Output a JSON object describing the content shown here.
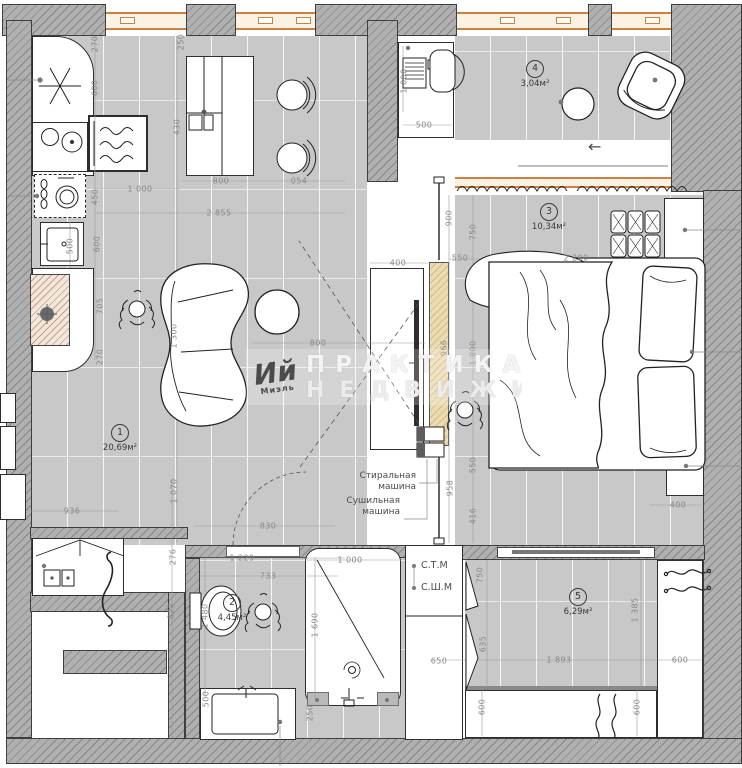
{
  "watermark": {
    "logo": "Ий",
    "logo_sub": "Миэль",
    "line1": "ПРАКТИКА",
    "line2": "НЕДВИЖИМ"
  },
  "rooms": [
    {
      "num": "1",
      "area": "20,69м²",
      "x": 98,
      "y": 424
    },
    {
      "num": "2",
      "area": "4,45м²",
      "x": 210,
      "y": 594
    },
    {
      "num": "3",
      "area": "10,34м²",
      "x": 527,
      "y": 203
    },
    {
      "num": "4",
      "area": "3,04м²",
      "x": 513,
      "y": 60
    },
    {
      "num": "5",
      "area": "6,29м²",
      "x": 556,
      "y": 588
    }
  ],
  "annotations": [
    {
      "lines": [
        "Стиральная",
        "машина"
      ],
      "x": 330,
      "y": 471,
      "w": 86,
      "align": "right",
      "fs": 9
    },
    {
      "lines": [
        "Сушильная",
        "машина"
      ],
      "x": 316,
      "y": 496,
      "w": 84,
      "align": "right",
      "fs": 9
    },
    {
      "lines": [
        "С.Т.М"
      ],
      "x": 421,
      "y": 560,
      "w": 42,
      "align": "left",
      "fs": 9.5
    },
    {
      "lines": [
        "С.Ш.М"
      ],
      "x": 421,
      "y": 582,
      "w": 46,
      "align": "left",
      "fs": 9.5
    },
    {
      "lines": [
        "←"
      ],
      "x": 588,
      "y": 138,
      "w": 30,
      "align": "left",
      "fs": 16
    }
  ],
  "dimensions": [
    {
      "text": "270",
      "x": 95,
      "y": 44,
      "v": true
    },
    {
      "text": "250",
      "x": 181,
      "y": 42,
      "v": true
    },
    {
      "text": "600",
      "x": 95,
      "y": 88,
      "v": true
    },
    {
      "text": "430",
      "x": 177,
      "y": 127,
      "v": true
    },
    {
      "text": "450",
      "x": 95,
      "y": 197,
      "v": true
    },
    {
      "text": "600",
      "x": 97,
      "y": 244,
      "v": true
    },
    {
      "text": "705",
      "x": 100,
      "y": 306,
      "v": true
    },
    {
      "text": "270",
      "x": 100,
      "y": 357,
      "v": true
    },
    {
      "text": "500",
      "x": 70,
      "y": 246,
      "v": true
    },
    {
      "text": "1 000",
      "x": 140,
      "y": 189,
      "v": false
    },
    {
      "text": "800",
      "x": 221,
      "y": 181,
      "v": false
    },
    {
      "text": "054",
      "x": 299,
      "y": 181,
      "v": false
    },
    {
      "text": "2 855",
      "x": 219,
      "y": 213,
      "v": false
    },
    {
      "text": "800",
      "x": 318,
      "y": 343,
      "v": false
    },
    {
      "text": "1 300",
      "x": 174,
      "y": 336,
      "v": true
    },
    {
      "text": "1 070",
      "x": 174,
      "y": 491,
      "v": true
    },
    {
      "text": "1 000",
      "x": 404,
      "y": 81,
      "v": true
    },
    {
      "text": "500",
      "x": 424,
      "y": 125,
      "v": false
    },
    {
      "text": "900",
      "x": 449,
      "y": 218,
      "v": true
    },
    {
      "text": "750",
      "x": 473,
      "y": 232,
      "v": true
    },
    {
      "text": "550",
      "x": 460,
      "y": 258,
      "v": false
    },
    {
      "text": "2 200",
      "x": 576,
      "y": 258,
      "v": false
    },
    {
      "text": "400",
      "x": 398,
      "y": 263,
      "v": false
    },
    {
      "text": "966",
      "x": 444,
      "y": 348,
      "v": true
    },
    {
      "text": "1 800",
      "x": 473,
      "y": 353,
      "v": true
    },
    {
      "text": "550",
      "x": 473,
      "y": 465,
      "v": true
    },
    {
      "text": "958",
      "x": 450,
      "y": 488,
      "v": true
    },
    {
      "text": "416",
      "x": 473,
      "y": 516,
      "v": true
    },
    {
      "text": "400",
      "x": 678,
      "y": 505,
      "v": false
    },
    {
      "text": "936",
      "x": 72,
      "y": 511,
      "v": false
    },
    {
      "text": "830",
      "x": 268,
      "y": 526,
      "v": false
    },
    {
      "text": "1 229",
      "x": 242,
      "y": 558,
      "v": false
    },
    {
      "text": "733",
      "x": 268,
      "y": 576,
      "v": false
    },
    {
      "text": "276",
      "x": 173,
      "y": 557,
      "v": true
    },
    {
      "text": "822",
      "x": 171,
      "y": 611,
      "v": true
    },
    {
      "text": "1 480",
      "x": 205,
      "y": 616,
      "v": true
    },
    {
      "text": "1 000",
      "x": 350,
      "y": 560,
      "v": false
    },
    {
      "text": "1 690",
      "x": 315,
      "y": 625,
      "v": true
    },
    {
      "text": "500",
      "x": 206,
      "y": 699,
      "v": true
    },
    {
      "text": "250",
      "x": 310,
      "y": 713,
      "v": true
    },
    {
      "text": "650",
      "x": 439,
      "y": 661,
      "v": false
    },
    {
      "text": "635",
      "x": 483,
      "y": 644,
      "v": true
    },
    {
      "text": "750",
      "x": 480,
      "y": 575,
      "v": true
    },
    {
      "text": "1 893",
      "x": 559,
      "y": 660,
      "v": false
    },
    {
      "text": "600",
      "x": 680,
      "y": 660,
      "v": false
    },
    {
      "text": "600",
      "x": 482,
      "y": 707,
      "v": true
    },
    {
      "text": "600",
      "x": 637,
      "y": 707,
      "v": true
    },
    {
      "text": "1 385",
      "x": 635,
      "y": 610,
      "v": true
    }
  ]
}
